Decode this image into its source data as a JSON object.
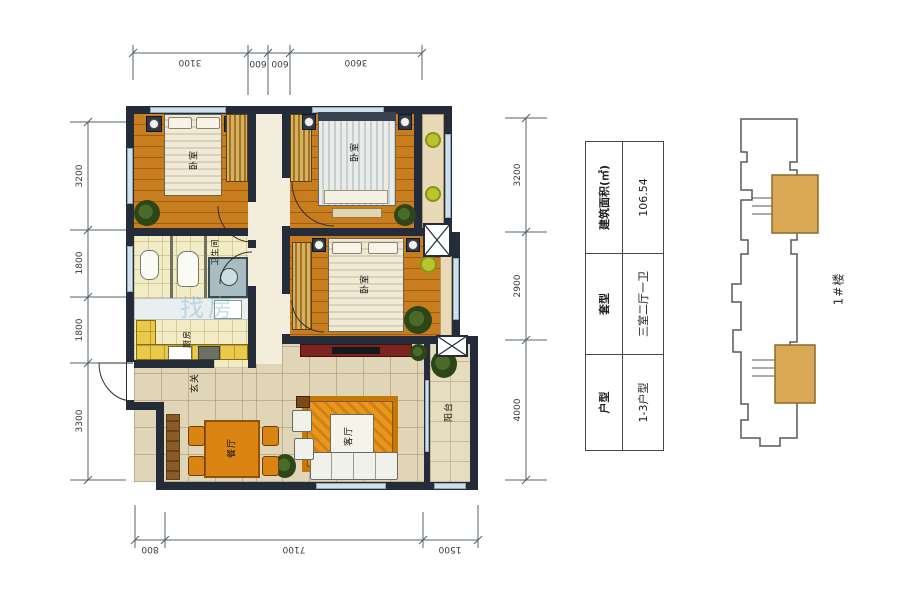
{
  "watermark": {
    "text": "找房"
  },
  "dimensions": {
    "top": [
      "3100",
      "600",
      "600",
      "3600"
    ],
    "bottom": [
      "800",
      "7100",
      "1500"
    ],
    "left": [
      "3200",
      "1800",
      "1800",
      "3300"
    ],
    "right": [
      "3200",
      "2900",
      "4000"
    ]
  },
  "rooms": {
    "bedroom1": "卧室",
    "bedroom2": "卧室",
    "bedroom3": "卧室",
    "bathroom": "卫生间",
    "kitchen": "厨房",
    "entry": "玄关",
    "dining": "餐厅",
    "living": "客厅",
    "balcony": "阳台"
  },
  "info_table": {
    "rows": [
      {
        "label": "户型",
        "value": "1-3户型"
      },
      {
        "label": "套型",
        "value": "三室二厅一卫"
      },
      {
        "label": "建筑面积(㎡)",
        "value": "106.54"
      }
    ]
  },
  "keyplan": {
    "label": "1#楼",
    "unit_highlight": "#d9a855"
  },
  "colors": {
    "wall": "#232c38",
    "wood_floor": "#c87d1f",
    "tile_floor": "#e0d5b6",
    "kitchen_bath_floor": "#f1ebc6",
    "counter": "#e9ca4a",
    "rug": "#e8971e",
    "plant": "#2c4617",
    "window": "#cfe0ea"
  }
}
